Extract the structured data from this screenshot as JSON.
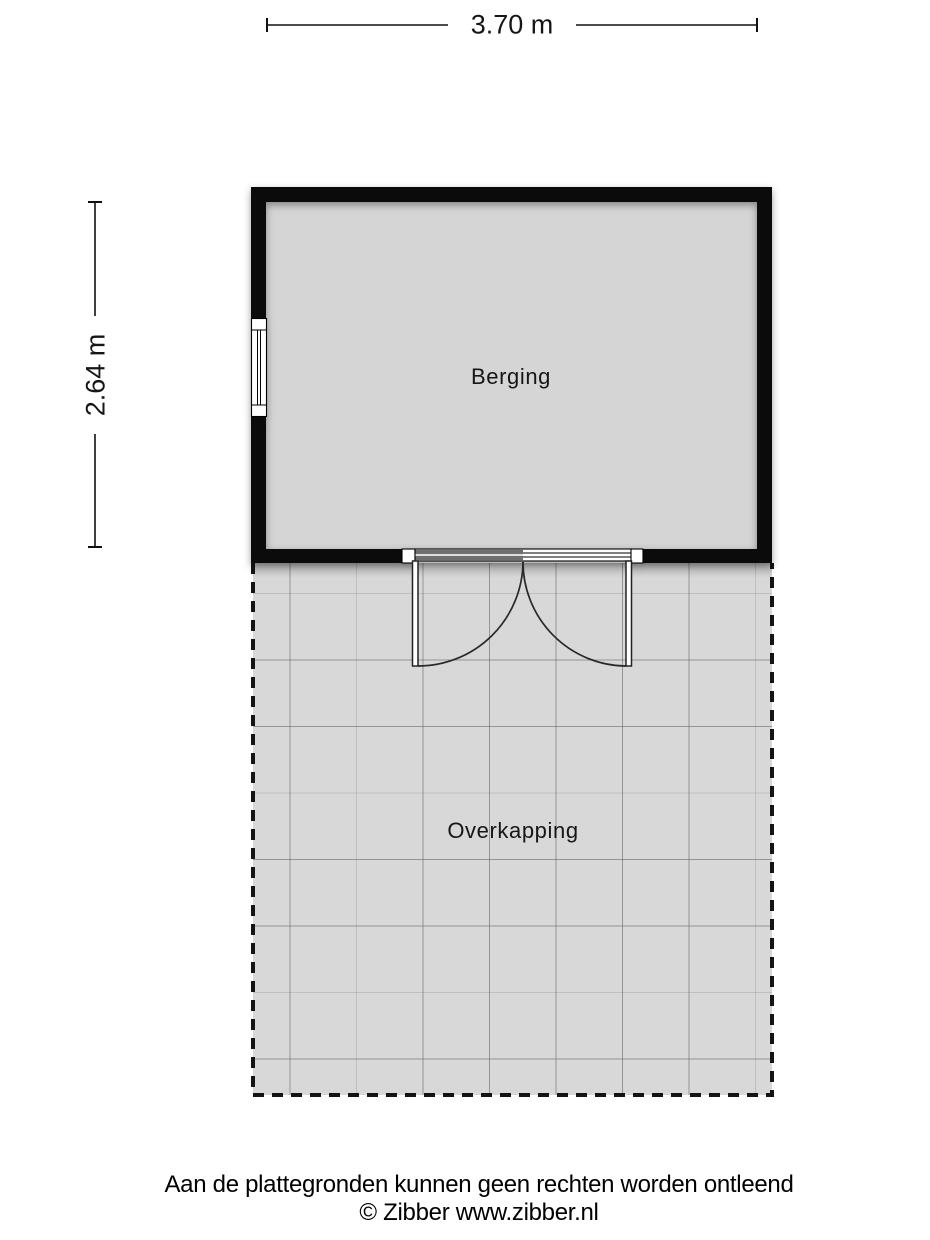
{
  "floorplan": {
    "rooms": [
      {
        "label": "Berging"
      },
      {
        "label": "Overkapping"
      }
    ],
    "dimensions": {
      "width": "3.70 m",
      "height": "2.64 m"
    },
    "colors": {
      "wall": "#0b0b0b",
      "room_fill": "#d5d5d5",
      "terrace_fill": "#d8d8d8",
      "grid_line": "#5f5f5f",
      "boundary_dash": "#141414",
      "dimension_line": "#111111",
      "text": "#161616",
      "background": "#ffffff"
    },
    "grid": {
      "region": {
        "x1": 253,
        "y1": 563,
        "x2": 772,
        "y2": 1095
      },
      "vertical_strong": [
        290,
        423,
        489.5,
        556,
        622.5,
        689
      ],
      "vertical_faint": [
        356.5,
        755.5
      ],
      "horizontal_strong": [
        660,
        726.5,
        859.5,
        926,
        1059
      ],
      "horizontal_faint": [
        593.5,
        793,
        992.5
      ]
    }
  },
  "footer": {
    "disclaimer": "Aan de plattegronden kunnen geen rechten worden ontleend",
    "copyright": "© Zibber www.zibber.nl"
  }
}
